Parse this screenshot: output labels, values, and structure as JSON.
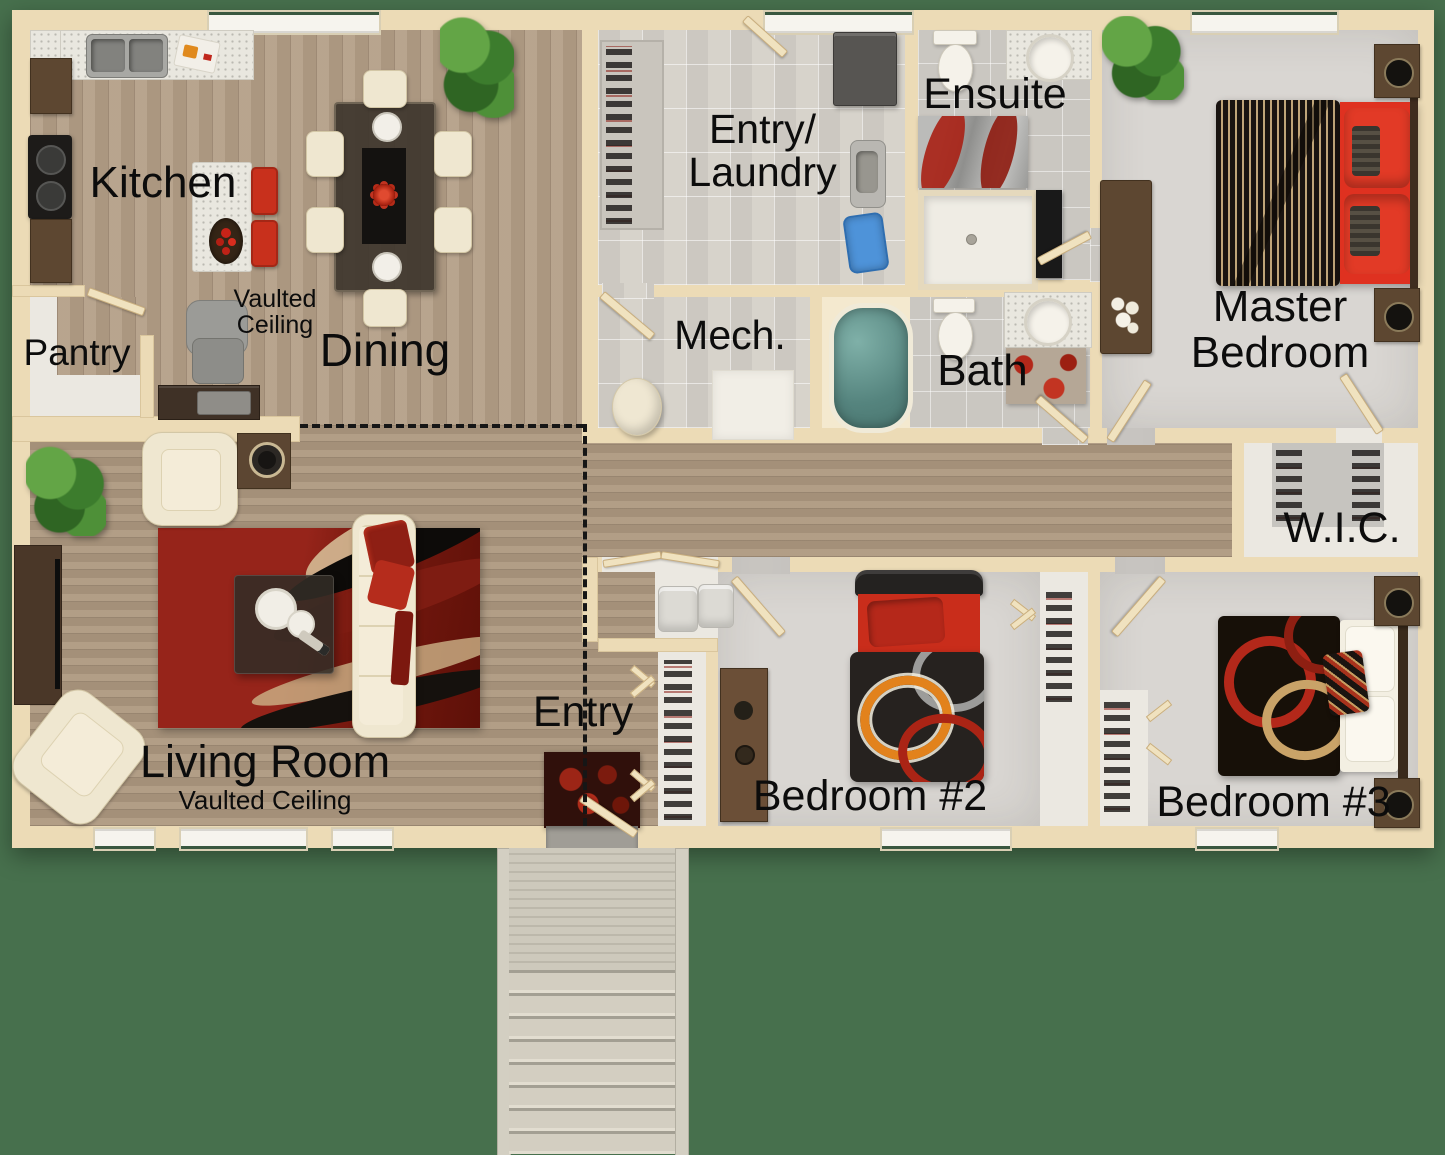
{
  "scene": {
    "type": "floor-plan",
    "background_color": "#47704d"
  },
  "palette": {
    "wall": "#ecdbb6",
    "wood_floor": "#b49f87",
    "tile_floor": "#d7d3cb",
    "carpet": "#d9d6d2",
    "accent_red": "#d93222",
    "label_text": "#0c0c0c"
  },
  "rooms": {
    "kitchen": {
      "label": "Kitchen"
    },
    "dining": {
      "label": "Dining",
      "note_line1": "Vaulted",
      "note_line2": "Ceiling"
    },
    "pantry": {
      "label": "Pantry"
    },
    "living": {
      "label": "Living Room",
      "note": "Vaulted Ceiling"
    },
    "entry_laundry": {
      "line1": "Entry/",
      "line2": "Laundry"
    },
    "mech": {
      "label": "Mech."
    },
    "bath": {
      "label": "Bath"
    },
    "ensuite": {
      "label": "Ensuite"
    },
    "master": {
      "line1": "Master",
      "line2": "Bedroom"
    },
    "wic": {
      "label": "W.I.C."
    },
    "entry": {
      "label": "Entry"
    },
    "bedroom2": {
      "label": "Bedroom #2"
    },
    "bedroom3": {
      "label": "Bedroom #3"
    }
  }
}
